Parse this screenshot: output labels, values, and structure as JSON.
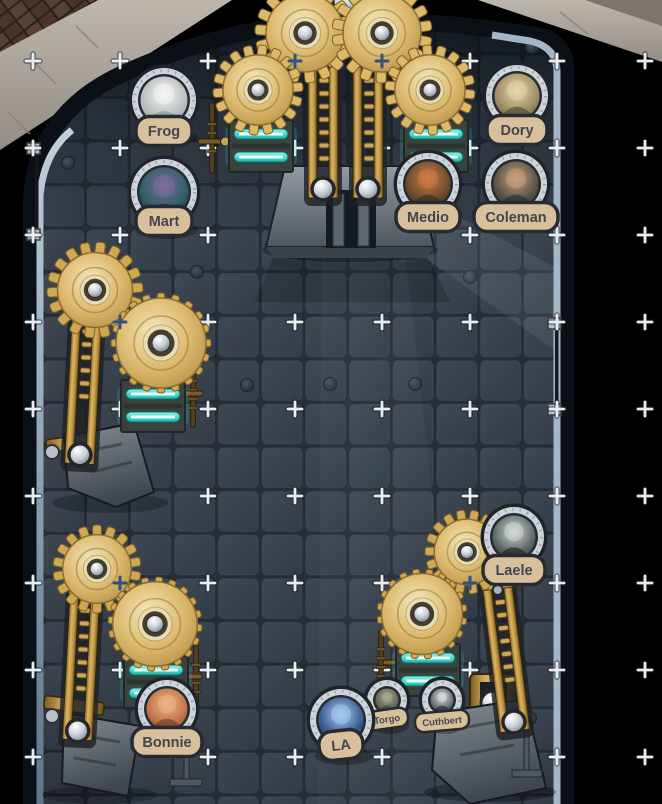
{
  "map": {
    "tokens": [
      {
        "name": "Frog"
      },
      {
        "name": "Mart"
      },
      {
        "name": "Dory"
      },
      {
        "name": "Medio"
      },
      {
        "name": "Coleman"
      },
      {
        "name": "Laele"
      },
      {
        "name": "Bonnie"
      },
      {
        "name": "LA"
      },
      {
        "name": "Torgo"
      },
      {
        "name": "Cuthbert"
      }
    ],
    "colors": {
      "glow_teal": "#3fe0d6",
      "brass_gold": "#d6b269",
      "token_plate": "#d9c09c",
      "floor_tile": "#3a434e",
      "edge_highlight": "#a3b6c6",
      "grid_cross": "#e9edf0",
      "snap_cross": "#33527f"
    }
  }
}
